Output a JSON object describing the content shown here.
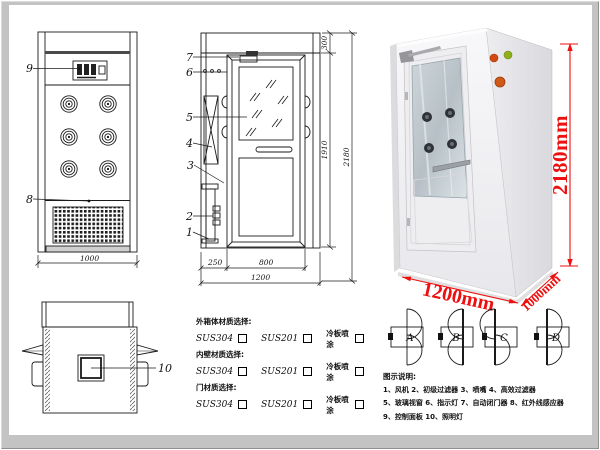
{
  "front_view": {
    "callout_9": "9",
    "callout_8": "8",
    "dim_width": "1000"
  },
  "plan_view": {
    "callout_10": "10"
  },
  "side_view": {
    "callout_7": "7",
    "callout_6": "6",
    "callout_5": "5",
    "callout_4": "4",
    "callout_3": "3",
    "callout_2": "2",
    "callout_1": "1",
    "dim_top": "300",
    "dim_door_h": "1910",
    "dim_total_h": "2180",
    "dim_left": "250",
    "dim_door_w": "800",
    "dim_total_w": "1200"
  },
  "photo": {
    "dim_height": "2180mm",
    "dim_width": "1200mm",
    "dim_depth": "1000mm",
    "accent_color": "#ee0f0f"
  },
  "materials": {
    "sections": [
      {
        "title": "外箱体材质选择:",
        "options": [
          "SUS304",
          "SUS201",
          "冷板喷涂"
        ]
      },
      {
        "title": "内壁材质选择:",
        "options": [
          "SUS304",
          "SUS201",
          "冷板喷涂"
        ]
      },
      {
        "title": "门材质选择:",
        "options": [
          "SUS304",
          "SUS201",
          "冷板喷涂"
        ]
      }
    ]
  },
  "door_options": {
    "labels": [
      "A",
      "B",
      "C",
      "D"
    ]
  },
  "legend": {
    "title": "图示说明:",
    "lines": [
      "1、风机   2、初级过滤器   3、喷嘴   4、高效过滤器",
      "5、玻璃视窗   6、指示灯   7、自动闭门器   8、红外线感应器",
      "9、控制面板   10、照明灯"
    ]
  }
}
